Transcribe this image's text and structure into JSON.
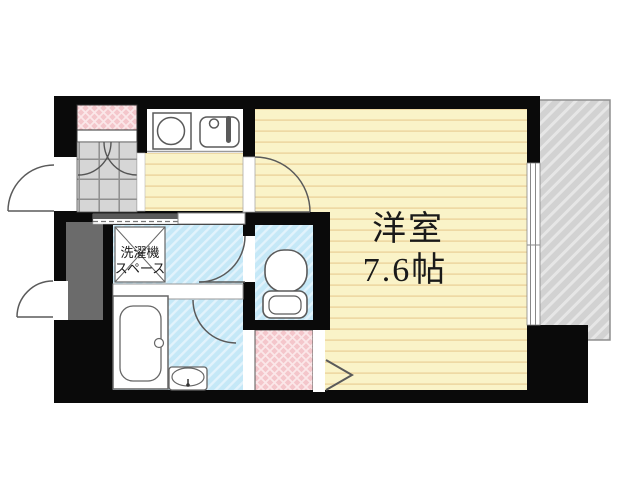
{
  "title": "apartment-floor-plan",
  "labels": {
    "main_room_name": "洋室",
    "main_room_size": "7.6帖",
    "laundry_line1": "洗濯機",
    "laundry_line2": "スペース"
  },
  "rooms": [
    {
      "name": "main-room",
      "label": "洋室 7.6帖",
      "floor": "wood-stripe-yellow"
    },
    {
      "name": "kitchen-hall",
      "floor": "wood-stripe-yellow"
    },
    {
      "name": "entrance-genkan",
      "floor": "gray-tile-grid"
    },
    {
      "name": "entrance-porch",
      "floor": "pink-tile"
    },
    {
      "name": "washroom-laundry",
      "label": "洗濯機スペース",
      "floor": "blue-stripe"
    },
    {
      "name": "bathroom-unit-bath",
      "floor": "blue-stripe"
    },
    {
      "name": "toilet-room",
      "floor": "blue-stripe"
    },
    {
      "name": "closet-nook",
      "floor": "pink-tile"
    },
    {
      "name": "balcony",
      "floor": "gray-hatch"
    }
  ],
  "colors": {
    "wall": "#0a0a0a",
    "room_floor": "#faf3c8",
    "room_floor_stripe": "#eed9a4",
    "wet_floor": "#c5e8f7",
    "wet_floor_stripe": "#e2f3fc",
    "tile_pink": "#f4c6cb",
    "tile_pink_lattice": "#fbe7e9",
    "entrance_tile": "#d6d6d6",
    "entrance_tile_line": "#8f8f8f",
    "balcony_fill": "#d2d2d2",
    "balcony_stripe": "#e6e6e6",
    "shaft_box": "#6b6b6b",
    "fixture_stroke": "#5a5a5a"
  }
}
